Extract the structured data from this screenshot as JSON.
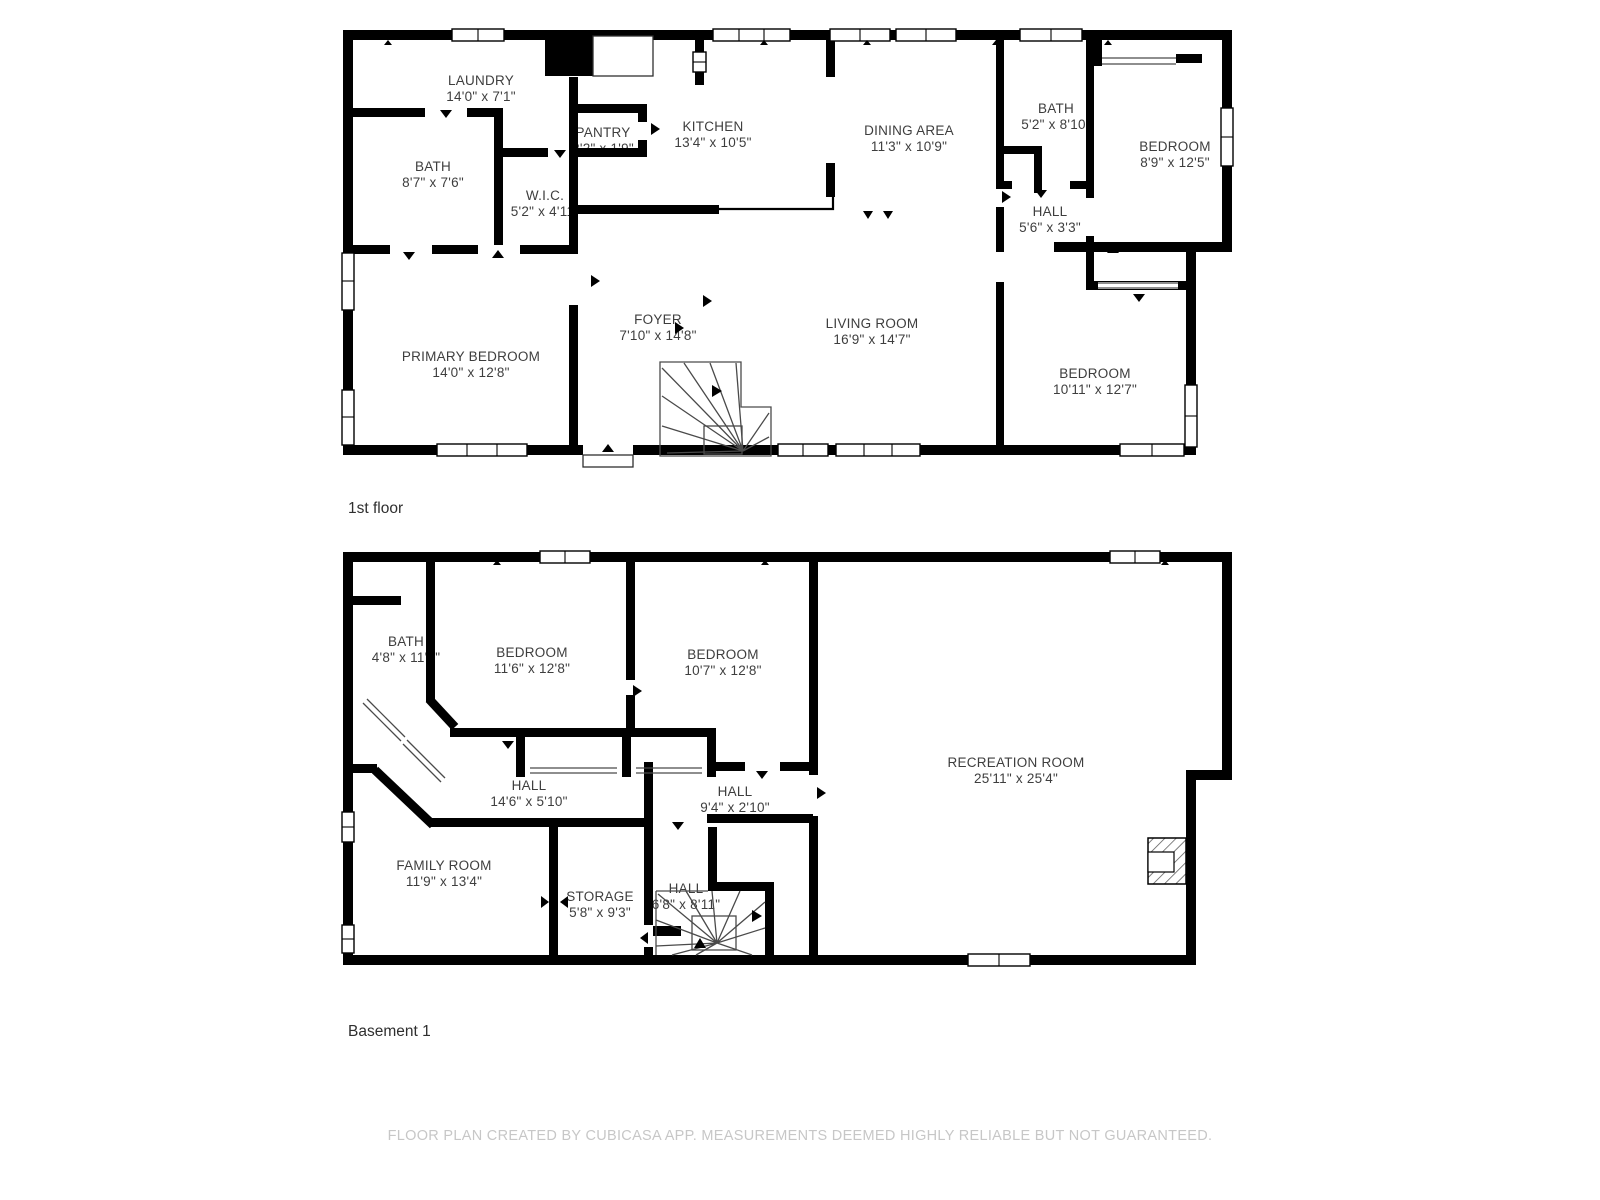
{
  "page": {
    "width": 1600,
    "height": 1200
  },
  "colors": {
    "bg": "#ffffff",
    "wall": "#000000",
    "label": "#3e3e3e",
    "floor-title": "#2f2f2f",
    "footer": "#c7c7c7"
  },
  "footer": {
    "text": "FLOOR PLAN CREATED BY CUBICASA APP. MEASUREMENTS DEEMED HIGHLY RELIABLE BUT NOT GUARANTEED."
  },
  "floors": [
    {
      "title": "1st floor",
      "rooms": [
        {
          "name": "LAUNDRY",
          "dims": "14'0\" x 7'1\""
        },
        {
          "name": "BATH",
          "dims": "8'7\" x 7'6\""
        },
        {
          "name": "PANTRY",
          "dims": "2'2\" x 1'9\""
        },
        {
          "name": "W.I.C.",
          "dims": "5'2\" x 4'11\""
        },
        {
          "name": "KITCHEN",
          "dims": "13'4\" x 10'5\""
        },
        {
          "name": "DINING AREA",
          "dims": "11'3\" x 10'9\""
        },
        {
          "name": "BATH",
          "dims": "5'2\" x 8'10\""
        },
        {
          "name": "BEDROOM",
          "dims": "8'9\" x 12'5\""
        },
        {
          "name": "HALL",
          "dims": "5'6\" x 3'3\""
        },
        {
          "name": "FOYER",
          "dims": "7'10\" x 14'8\""
        },
        {
          "name": "PRIMARY BEDROOM",
          "dims": "14'0\" x 12'8\""
        },
        {
          "name": "LIVING ROOM",
          "dims": "16'9\" x 14'7\""
        },
        {
          "name": "BEDROOM",
          "dims": "10'11\" x 12'7\""
        }
      ]
    },
    {
      "title": "Basement 1",
      "rooms": [
        {
          "name": "BATH",
          "dims": "4'8\" x 11'1\""
        },
        {
          "name": "BEDROOM",
          "dims": "11'6\" x 12'8\""
        },
        {
          "name": "BEDROOM",
          "dims": "10'7\" x 12'8\""
        },
        {
          "name": "RECREATION ROOM",
          "dims": "25'11\" x 25'4\""
        },
        {
          "name": "HALL",
          "dims": "14'6\" x 5'10\""
        },
        {
          "name": "HALL",
          "dims": "9'4\" x 2'10\""
        },
        {
          "name": "FAMILY ROOM",
          "dims": "11'9\" x 13'4\""
        },
        {
          "name": "STORAGE",
          "dims": "5'8\" x 9'3\""
        },
        {
          "name": "HALL",
          "dims": "6'8\" x 8'11\""
        }
      ]
    }
  ]
}
